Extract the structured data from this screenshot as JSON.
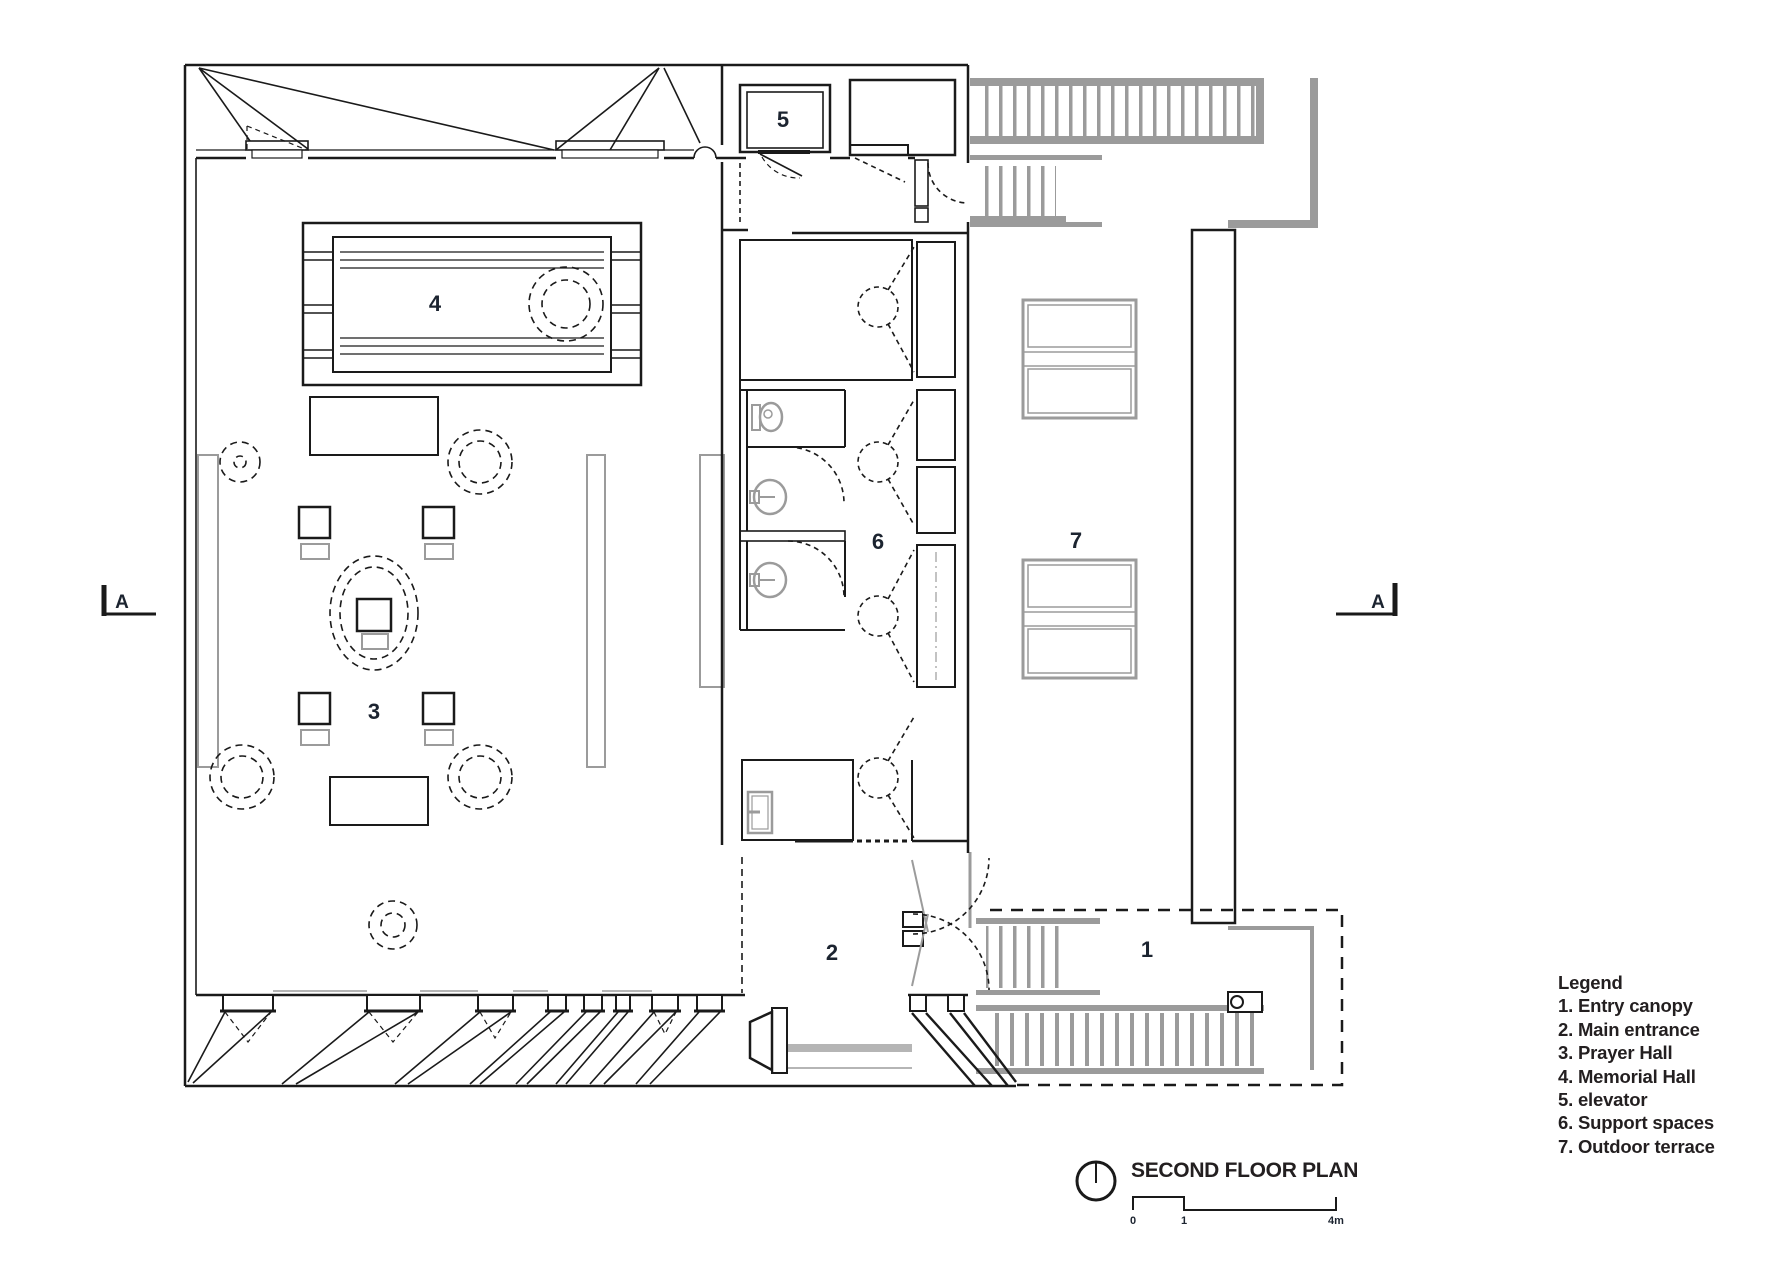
{
  "plan": {
    "section_label": "A",
    "room_labels": {
      "entry_canopy": "1",
      "main_entrance": "2",
      "prayer_hall": "3",
      "memorial_hall": "4",
      "elevator": "5",
      "support_spaces": "6",
      "outdoor_terrace": "7"
    }
  },
  "legend": {
    "title": "Legend",
    "items": [
      "1. Entry canopy",
      "2. Main entrance",
      "3. Prayer Hall",
      "4. Memorial Hall",
      "5. elevator",
      "6. Support spaces",
      "7. Outdoor terrace"
    ]
  },
  "title_block": {
    "title": "SECOND FLOOR PLAN",
    "scale_labels": {
      "start": "0",
      "mid": "1",
      "end": "4m"
    }
  },
  "colors": {
    "line": "#1a1a1a",
    "gray": "#9b9b9b",
    "label": "#1c2430"
  }
}
